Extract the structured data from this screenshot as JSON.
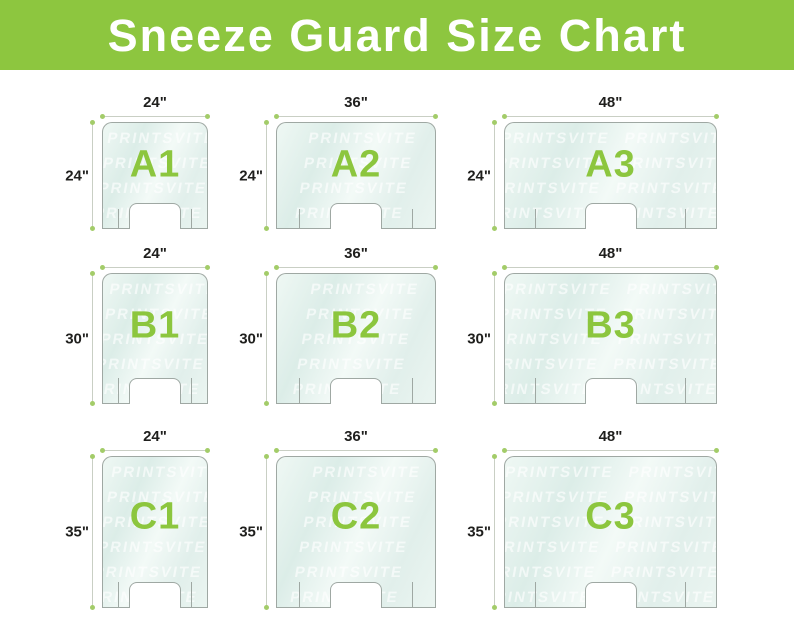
{
  "header": {
    "title": "Sneeze Guard Size Chart"
  },
  "watermark_text": "PRINTSVITE",
  "colors": {
    "header_green": "#8dc63f",
    "label_green": "#8cc63e",
    "dot_green": "#a3cc69",
    "line_gray": "#c9cfc4",
    "panel_border": "#9fa8a3",
    "dim_text": "#1f1f1d"
  },
  "rows": [
    {
      "name": "A",
      "panels": [
        {
          "label": "A1",
          "width_label": "24\"",
          "height_label": "24\""
        },
        {
          "label": "A2",
          "width_label": "36\"",
          "height_label": "24\""
        },
        {
          "label": "A3",
          "width_label": "48\"",
          "height_label": "24\""
        }
      ]
    },
    {
      "name": "B",
      "panels": [
        {
          "label": "B1",
          "width_label": "24\"",
          "height_label": "30\""
        },
        {
          "label": "B2",
          "width_label": "36\"",
          "height_label": "30\""
        },
        {
          "label": "B3",
          "width_label": "48\"",
          "height_label": "30\""
        }
      ]
    },
    {
      "name": "C",
      "panels": [
        {
          "label": "C1",
          "width_label": "24\"",
          "height_label": "35\""
        },
        {
          "label": "C2",
          "width_label": "36\"",
          "height_label": "35\""
        },
        {
          "label": "C3",
          "width_label": "48\"",
          "height_label": "35\""
        }
      ]
    }
  ]
}
